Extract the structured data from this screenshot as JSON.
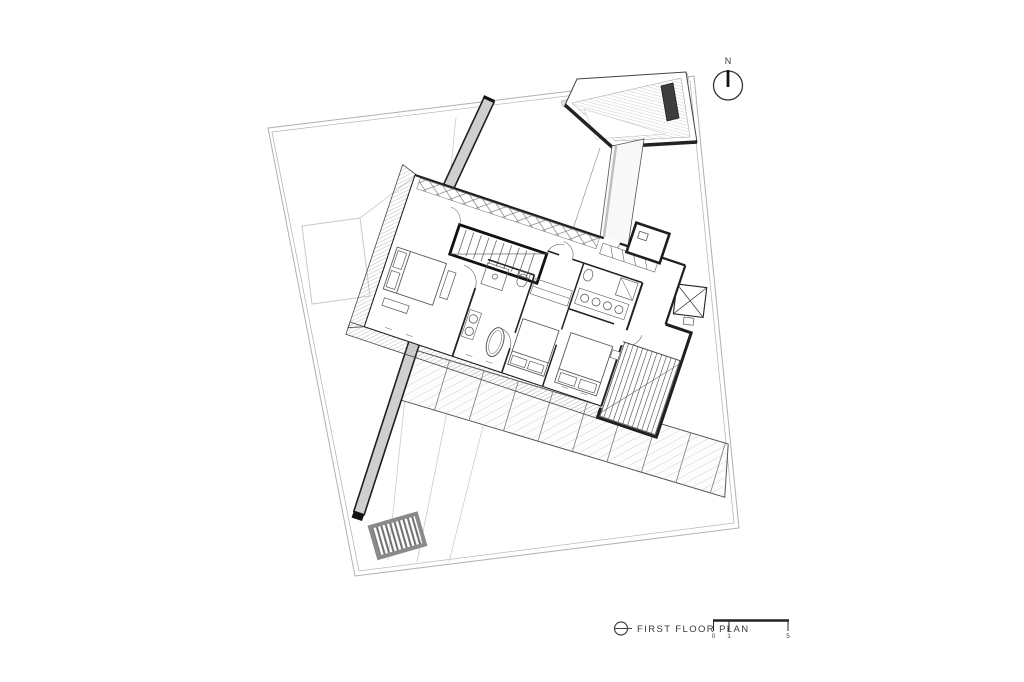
{
  "page": {
    "background": "#ffffff"
  },
  "drawing": {
    "type": "architectural-floor-plan",
    "title": "FIRST FLOOR PLAN",
    "north": {
      "label": "N"
    },
    "scale_bar": {
      "tick_labels": [
        "0",
        "1",
        "5"
      ]
    },
    "palette": {
      "line_dark": "#1f1f1f",
      "line_medium": "#4a4a4a",
      "furniture_line": "#5a5a5a",
      "light_line": "#c8c8c8",
      "boundary_line": "#b0b0b0",
      "wall_fill": "#cfcfcf",
      "pool_dark_fill": "#3d3d3d",
      "roof_band_fill": "#e0e0e0",
      "background": "#ffffff"
    },
    "icons": {
      "north_indicator": "north-compass-icon",
      "title_marker": "floor-level-marker-icon"
    }
  }
}
